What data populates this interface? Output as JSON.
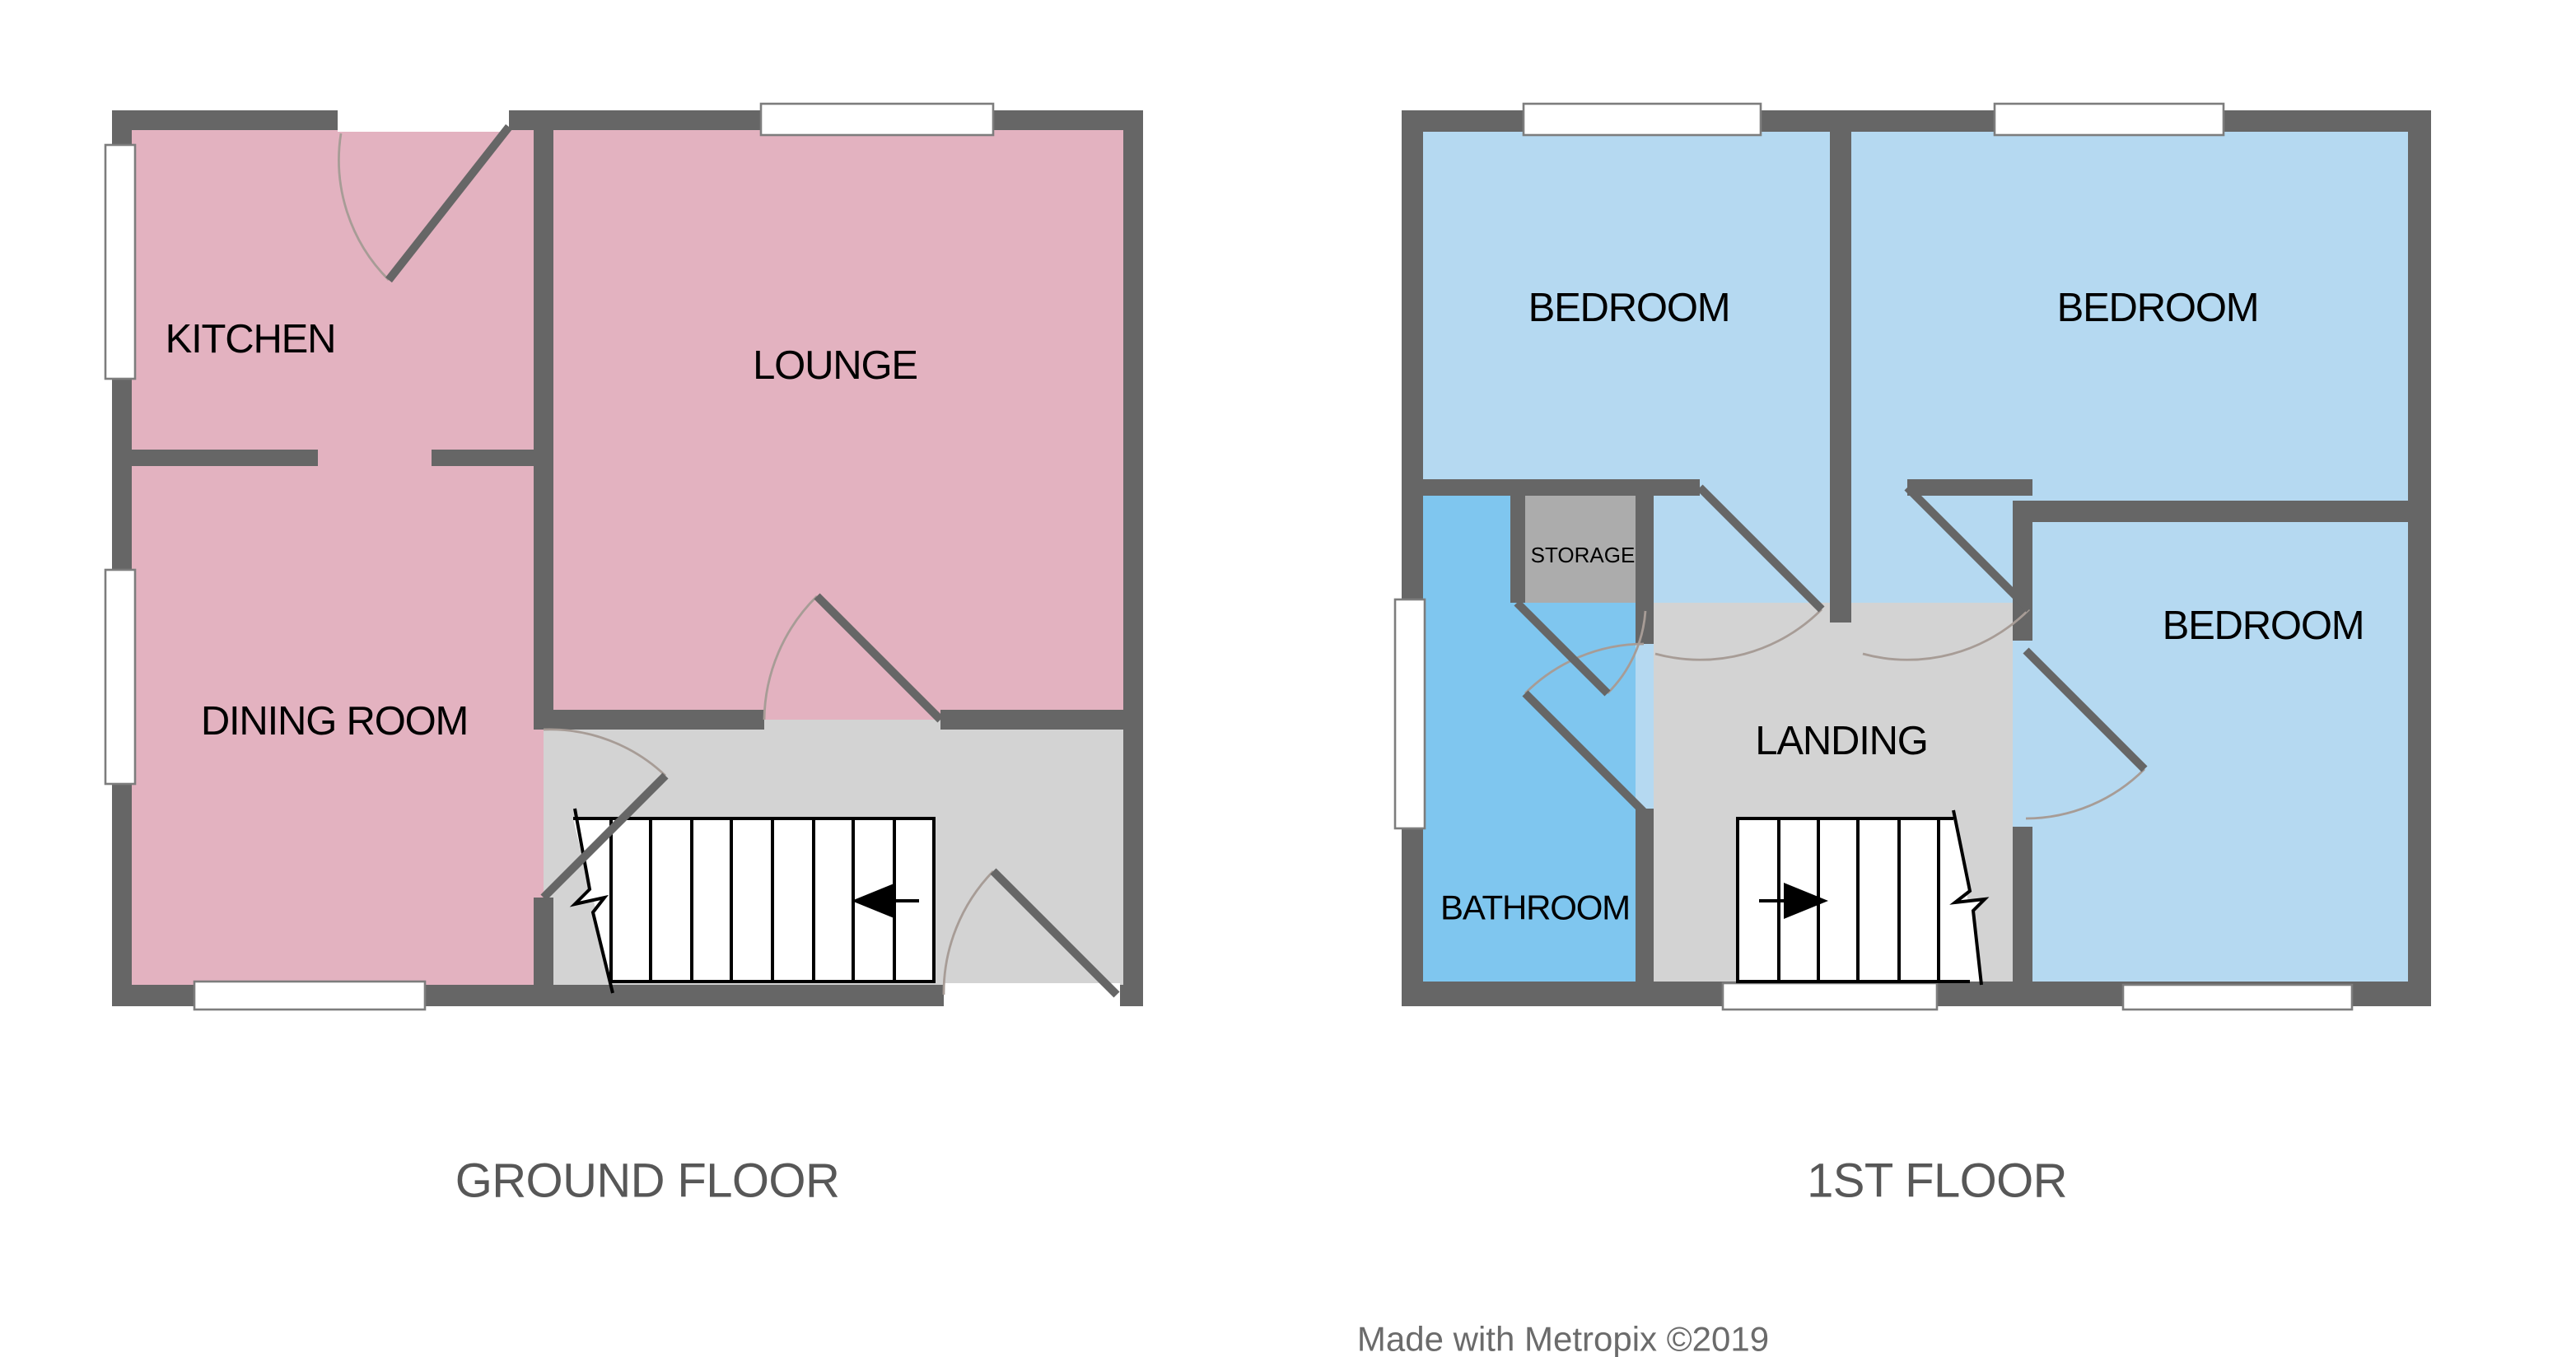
{
  "colors": {
    "wall": "#666666",
    "room_pink": "#E3B2C0",
    "bedroom_blue": "#B5D9F1",
    "bathroom_blue": "#7FC6EF",
    "hall_gray": "#D3D3D3",
    "storage_gray": "#ACACAC",
    "door_arc": "#A79C96",
    "title_text": "#575757",
    "credit_text": "#6B6B6B"
  },
  "ground_floor": {
    "title": "GROUND FLOOR",
    "rooms": [
      {
        "id": "kitchen",
        "label": "KITCHEN"
      },
      {
        "id": "lounge",
        "label": "LOUNGE"
      },
      {
        "id": "dining_room",
        "label": "DINING ROOM"
      }
    ]
  },
  "first_floor": {
    "title": "1ST FLOOR",
    "rooms": [
      {
        "id": "bedroom_left",
        "label": "BEDROOM"
      },
      {
        "id": "bedroom_right",
        "label": "BEDROOM"
      },
      {
        "id": "bedroom_third",
        "label": "BEDROOM"
      },
      {
        "id": "storage",
        "label": "STORAGE"
      },
      {
        "id": "landing",
        "label": "LANDING"
      },
      {
        "id": "bathroom",
        "label": "BATHROOM"
      }
    ]
  },
  "credit": "Made with Metropix ©2019"
}
